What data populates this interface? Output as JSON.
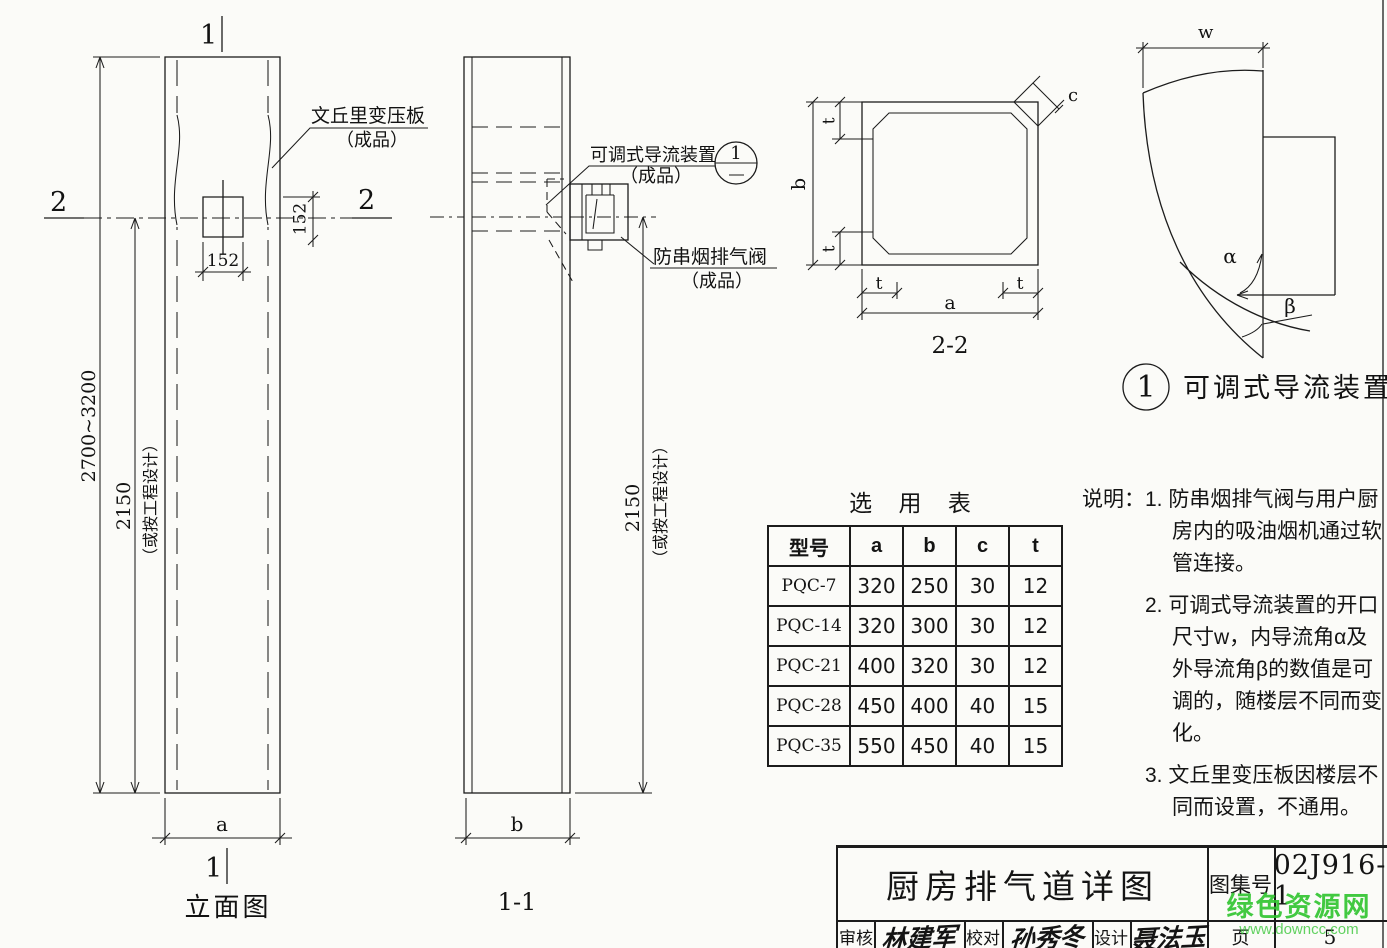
{
  "frame": {
    "line_color": "#1c1c1c",
    "bg": "#fbfbf8"
  },
  "elevation": {
    "title": "立面图",
    "marker_top": "1",
    "marker_bottom": "1",
    "marker_left": "2",
    "marker_right": "2",
    "callout_venturi": "文丘里变压板",
    "callout_venturi_sub": "（成品）",
    "dim_height_total": "2700~3200",
    "dim_height_flue": "2150",
    "dim_height_note": "（或按工程设计）",
    "dim_opening_w": "152",
    "dim_opening_h": "152",
    "dim_width": "a"
  },
  "section_1_1": {
    "title": "1-1",
    "dim_width": "b",
    "dim_height": "2150",
    "dim_height_note": "（或按工程设计）",
    "callout_guide": "可调式导流装置",
    "callout_guide_sub": "（成品）",
    "detail_ref": "1",
    "callout_valve": "防串烟排气阀",
    "callout_valve_sub": "（成品）"
  },
  "section_2_2": {
    "title": "2-2",
    "dim_a": "a",
    "dim_b": "b",
    "dim_c": "c",
    "dim_t": "t"
  },
  "detail_1": {
    "ref": "1",
    "title": "可调式导流装置",
    "dim_w": "w",
    "angle_inner": "α",
    "angle_outer": "β"
  },
  "selection_table": {
    "title": "选 用 表",
    "headers": [
      "型号",
      "a",
      "b",
      "c",
      "t"
    ],
    "rows": [
      [
        "PQC-7",
        "320",
        "250",
        "30",
        "12"
      ],
      [
        "PQC-14",
        "320",
        "300",
        "30",
        "12"
      ],
      [
        "PQC-21",
        "400",
        "320",
        "30",
        "12"
      ],
      [
        "PQC-28",
        "450",
        "400",
        "40",
        "15"
      ],
      [
        "PQC-35",
        "550",
        "450",
        "40",
        "15"
      ]
    ]
  },
  "notes": {
    "label": "说明：",
    "items": [
      "1. 防串烟排气阀与用户厨房内的吸油烟机通过软管连接。",
      "2. 可调式导流装置的开口尺寸w，内导流角α及外导流角β的数值是可调的，随楼层不同而变化。",
      "3. 文丘里变压板因楼层不同而设置，不通用。"
    ]
  },
  "title_block": {
    "drawing_title": "厨房排气道详图",
    "atlas_label": "图集号",
    "atlas_no": "02J916-1",
    "page_label": "页",
    "page_no": "5",
    "review_label": "审核",
    "review_sign": "林建军",
    "check_label": "校对",
    "check_sign": "孙秀冬",
    "design_label": "设计",
    "design_sign": "聂法玉"
  },
  "watermark": {
    "site_name": "绿色资源网",
    "site_url": "www.downcc.com",
    "color": "#2ec42e"
  }
}
